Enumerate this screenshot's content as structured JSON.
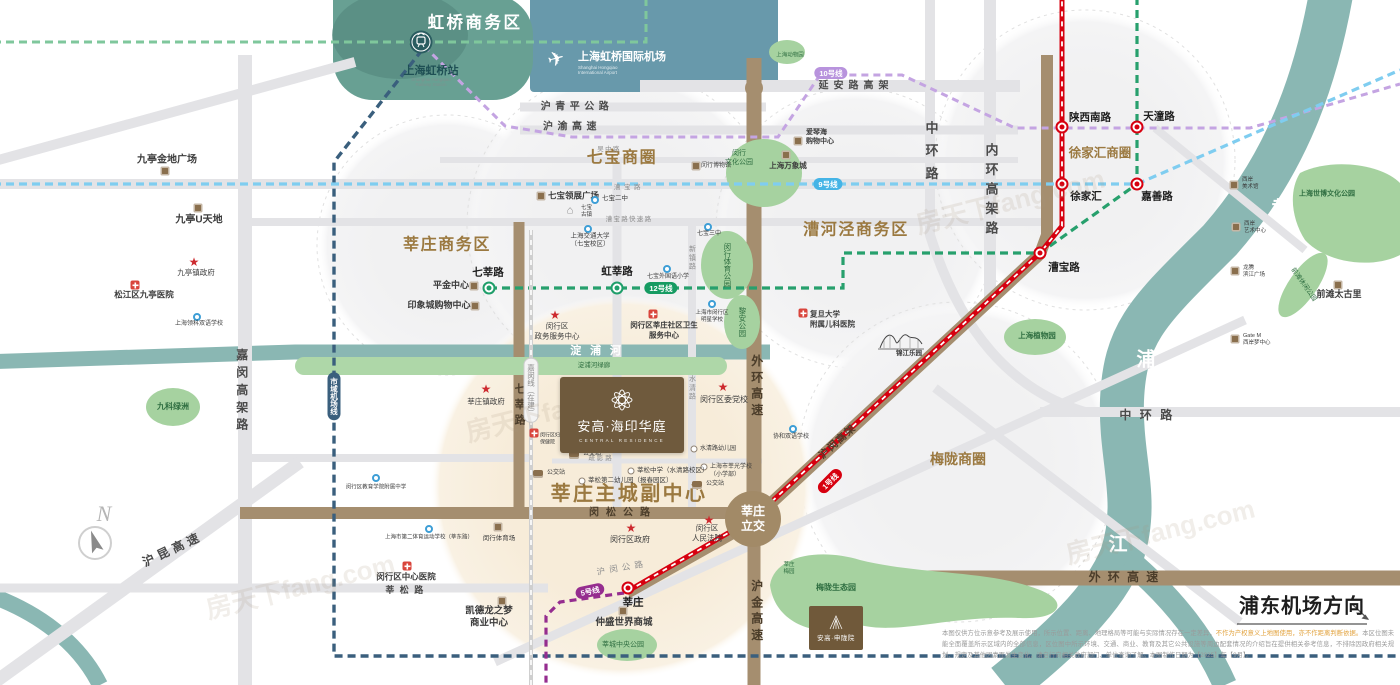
{
  "colors": {
    "brown": "#9b7940",
    "dbrown": "#4b3d2a",
    "ink": "#4a4a4a",
    "grey": "#8f8f8f",
    "white": "#ffffff",
    "green": "#2f6e41",
    "teal": "#1e4f54",
    "accent_red": "#d7000f",
    "metro_green": "#1f9e6a",
    "road_brown": "#a58e6f",
    "river_teal": "#8ab7b3",
    "park_green": "#a6d2a0"
  },
  "hongqiao": {
    "district": "虹桥商务区",
    "station_cn": "上海虹桥站",
    "station_en": "Shanghai Hongqiao\nRailway Station",
    "airport_cn": "上海虹桥国际机场",
    "airport_en": "Shanghai Hongqiao\nInternational Airport"
  },
  "property": {
    "cn": "安高·海印华庭",
    "en": "CENTRAL RESIDENCE"
  },
  "property2": {
    "cn": "安高·申陇院"
  },
  "interchange": {
    "t": "莘庄\n立交"
  },
  "direction": {
    "t": "浦东机场方向"
  },
  "compass": {
    "t": "N"
  },
  "watermark": "房天下fang.com",
  "disclaimer": {
    "p1": "本图仅供方位示意参考及展示使用，所示位置、距离、地理格局等可能与实际情况存在一定差异，",
    "hl": "不作为产权意义上地图使用，亦不作距离判断依据。",
    "p2": "本区位图未能全面覆盖所示区域内的全部信息，区位图中所示环境、交通、商业、教育及其它公共设施等周边配套情况的介绍旨在提供相关参考信息，不排除因政府相关规划、规定及其他因素而发生变化，请自行向相关政府部门、单位查询了解。本图制作日期为【2025】年【9月】。"
  },
  "labels": [
    {
      "n": "district-qibao",
      "t": "七宝商圈",
      "x": 622,
      "y": 159,
      "s": 16,
      "c": "brown",
      "b": 1,
      "ls": 0.1
    },
    {
      "n": "district-xinzhuang-biz",
      "t": "莘庄商务区",
      "x": 447,
      "y": 246,
      "s": 16,
      "c": "brown",
      "b": 1,
      "ls": 0.1
    },
    {
      "n": "district-caohejing",
      "t": "漕河泾商务区",
      "x": 856,
      "y": 231,
      "s": 16,
      "c": "brown",
      "b": 1,
      "ls": 0.1
    },
    {
      "n": "district-xujiahui",
      "t": "徐家汇商圈",
      "x": 1100,
      "y": 153,
      "s": 12.5,
      "c": "brown",
      "b": 1
    },
    {
      "n": "district-meilong",
      "t": "梅陇商圈",
      "x": 958,
      "y": 459,
      "s": 14,
      "c": "brown",
      "b": 1
    },
    {
      "n": "label-subcenter",
      "t": "莘庄主城副中心",
      "x": 629,
      "y": 494,
      "s": 20,
      "c": "brown",
      "b": 1,
      "ls": 0.12
    },
    {
      "n": "road-huqingping",
      "t": "沪青平公路",
      "x": 577,
      "y": 107,
      "s": 10,
      "c": "ink",
      "b": 1,
      "ls": 0.45
    },
    {
      "n": "road-huyu",
      "t": "沪渝高速",
      "x": 572,
      "y": 127,
      "s": 10,
      "c": "ink",
      "b": 1,
      "ls": 0.45
    },
    {
      "n": "road-wuzhong",
      "t": "吴中路",
      "x": 609,
      "y": 150,
      "s": 6.5,
      "c": "grey",
      "ls": 0.2
    },
    {
      "n": "road-caobao",
      "t": "漕宝路",
      "x": 629,
      "y": 188,
      "s": 6.5,
      "c": "grey",
      "ls": 0.55
    },
    {
      "n": "road-caobao-exp",
      "t": "漕宝路快速路",
      "x": 629,
      "y": 220,
      "s": 6.5,
      "c": "grey",
      "ls": 0.2
    },
    {
      "n": "road-yanan-elevated",
      "t": "延安路高架",
      "x": 856,
      "y": 86,
      "s": 10,
      "c": "ink",
      "b": 1,
      "ls": 0.5
    },
    {
      "n": "road-zhonghuan-v",
      "t": "中环路",
      "x": 930,
      "y": 155,
      "s": 13,
      "c": "ink",
      "b": 1,
      "v": 1,
      "ls": 0.75
    },
    {
      "n": "road-neihuan-v",
      "t": "内环高架路",
      "x": 990,
      "y": 192,
      "s": 13,
      "c": "ink",
      "b": 1,
      "v": 1,
      "ls": 0.5
    },
    {
      "n": "road-zhonghuan-h",
      "t": "中环路",
      "x": 1150,
      "y": 416,
      "s": 12,
      "c": "ink",
      "b": 1,
      "ls": 0.7
    },
    {
      "n": "road-jiamin-elevated",
      "t": "嘉闵高架路",
      "x": 241,
      "y": 392,
      "s": 12,
      "c": "ink",
      "b": 1,
      "v": 1,
      "ls": 0.45
    },
    {
      "n": "road-hukun",
      "t": "沪昆高速",
      "x": 173,
      "y": 550,
      "s": 12,
      "c": "ink",
      "b": 1,
      "r": -25,
      "ls": 0.35
    },
    {
      "n": "road-qixin",
      "t": "七莘路",
      "x": 519,
      "y": 406,
      "s": 11,
      "c": "dbrown",
      "b": 1,
      "v": 1,
      "ls": 0.4
    },
    {
      "n": "road-waihuan-v",
      "t": "外环高速",
      "x": 756,
      "y": 387,
      "s": 12,
      "c": "dbrown",
      "b": 1,
      "v": 1,
      "ls": 0.35
    },
    {
      "n": "road-hujin-v",
      "t": "沪金高速",
      "x": 756,
      "y": 612,
      "s": 12,
      "c": "dbrown",
      "b": 1,
      "v": 1,
      "ls": 0.35
    },
    {
      "n": "road-waihuan-h",
      "t": "外环高速",
      "x": 1127,
      "y": 578,
      "s": 12,
      "c": "dbrown",
      "b": 1,
      "ls": 0.6
    },
    {
      "n": "road-minsong",
      "t": "闵松公路",
      "x": 623,
      "y": 513,
      "s": 10,
      "c": "dbrown",
      "b": 1,
      "ls": 0.7
    },
    {
      "n": "road-xinsong",
      "t": "莘松路",
      "x": 407,
      "y": 591,
      "s": 9,
      "c": "ink",
      "b": 1,
      "ls": 0.6
    },
    {
      "n": "road-humin-hwy",
      "t": "沪闵公路",
      "x": 622,
      "y": 568,
      "s": 8.5,
      "c": "grey",
      "r": -10,
      "ls": 0.5
    },
    {
      "n": "road-humin-elevated",
      "t": "沪闵高架",
      "x": 838,
      "y": 442,
      "s": 10,
      "c": "dbrown",
      "b": 1,
      "r": -42,
      "ls": 0.15
    },
    {
      "n": "road-shuying",
      "t": "疏影路",
      "x": 601,
      "y": 459,
      "s": 6.5,
      "c": "grey",
      "ls": 0.3
    },
    {
      "n": "road-shuiqing",
      "t": "水清路",
      "x": 692,
      "y": 388,
      "s": 7,
      "c": "grey",
      "v": 1,
      "ls": 0.25
    },
    {
      "n": "road-xinzhen",
      "t": "新镇路",
      "x": 692,
      "y": 258,
      "s": 7,
      "c": "grey",
      "v": 1,
      "ls": 0.25
    },
    {
      "n": "river-dianpu",
      "t": "淀浦河",
      "x": 600,
      "y": 351,
      "s": 11,
      "c": "white",
      "b": 1,
      "ls": 0.8
    },
    {
      "n": "river-huangpu-huang",
      "t": "黄",
      "x": 1281,
      "y": 210,
      "s": 19,
      "c": "white",
      "b": 1
    },
    {
      "n": "river-huangpu-pu",
      "t": "浦",
      "x": 1146,
      "y": 361,
      "s": 19,
      "c": "white",
      "b": 1
    },
    {
      "n": "river-huangpu-jiang",
      "t": "江",
      "x": 1118,
      "y": 546,
      "s": 19,
      "c": "white",
      "b": 1
    },
    {
      "n": "park-dianpu-greenway",
      "t": "淀浦河绿廊",
      "x": 594,
      "y": 366,
      "s": 6.5,
      "c": "green"
    },
    {
      "n": "park-minhang-culture",
      "t": "闵行\n文化公园",
      "x": 739,
      "y": 158,
      "s": 7,
      "c": "green"
    },
    {
      "n": "park-minhang-sports",
      "t": "闵行体育公园",
      "x": 727,
      "y": 265,
      "s": 7.5,
      "c": "green",
      "v": 1
    },
    {
      "n": "park-lian",
      "t": "黎安公园",
      "x": 742,
      "y": 322,
      "s": 7.5,
      "c": "green",
      "v": 1
    },
    {
      "n": "park-botanical",
      "t": "上海植物园",
      "x": 1037,
      "y": 336,
      "s": 7.5,
      "c": "green",
      "b": 1
    },
    {
      "n": "park-expo-culture",
      "t": "上海世博文化公园",
      "x": 1327,
      "y": 194,
      "s": 7,
      "c": "green",
      "b": 1
    },
    {
      "n": "park-qiantan-leisure",
      "t": "前滩休闲公园",
      "x": 1303,
      "y": 285,
      "s": 6.5,
      "c": "green",
      "r": 55
    },
    {
      "n": "park-xincheng-central",
      "t": "莘城中央公园",
      "x": 623,
      "y": 645,
      "s": 7,
      "c": "green"
    },
    {
      "n": "park-meilong-eco",
      "t": "梅陇生态园",
      "x": 836,
      "y": 588,
      "s": 8,
      "c": "green",
      "b": 1
    },
    {
      "n": "park-xinzhuang-plum",
      "t": "莘庄\n梅园",
      "x": 789,
      "y": 569,
      "s": 5.5,
      "c": "green"
    },
    {
      "n": "park-jiuke-oasis",
      "t": "九科绿洲",
      "x": 173,
      "y": 407,
      "s": 8,
      "c": "green",
      "b": 1
    },
    {
      "n": "park-zoo",
      "t": "上海动物园",
      "x": 790,
      "y": 56,
      "s": 5.5,
      "c": "green"
    }
  ],
  "badges": [
    {
      "n": "badge-line10",
      "t": "10号线",
      "x": 831,
      "y": 73,
      "k": "l10"
    },
    {
      "n": "badge-line9",
      "t": "9号线",
      "x": 828,
      "y": 184,
      "k": "l9"
    },
    {
      "n": "badge-line12",
      "t": "12号线",
      "x": 661,
      "y": 288,
      "k": "l12"
    },
    {
      "n": "badge-line5",
      "t": "5号线",
      "x": 590,
      "y": 591,
      "k": "l5",
      "r": -12
    },
    {
      "n": "badge-line1",
      "t": "1号线",
      "x": 830,
      "y": 481,
      "k": "l1",
      "r": -45
    },
    {
      "n": "badge-airport-link-line",
      "t": "市域机场线",
      "x": 334,
      "y": 396,
      "k": "airlink",
      "v": 1
    },
    {
      "n": "badge-jiamin-line",
      "t": "嘉闵线（在建）",
      "x": 531,
      "y": 390,
      "k": "jiamin",
      "v": 1
    }
  ],
  "stations": [
    {
      "n": "station-shanxinanlu",
      "t": "陕西南路",
      "x": 1062,
      "y": 127,
      "lx": 1090,
      "ly": 117
    },
    {
      "n": "station-tiantonglu",
      "t": "天潼路",
      "x": 1137,
      "y": 127,
      "lx": 1159,
      "ly": 116
    },
    {
      "n": "station-xujiahui",
      "t": "徐家汇",
      "x": 1062,
      "y": 184,
      "lx": 1086,
      "ly": 196
    },
    {
      "n": "station-jiashanlu",
      "t": "嘉善路",
      "x": 1137,
      "y": 184,
      "lx": 1157,
      "ly": 196
    },
    {
      "n": "station-caobaolu",
      "t": "漕宝路",
      "x": 1040,
      "y": 253,
      "lx": 1064,
      "ly": 267
    },
    {
      "n": "station-xinzhuang",
      "t": "莘庄",
      "x": 628,
      "y": 588,
      "lx": 633,
      "ly": 602
    },
    {
      "n": "station-qixinlu",
      "t": "七莘路",
      "x": 489,
      "y": 288,
      "g": 1,
      "lx": 488,
      "ly": 272
    },
    {
      "n": "station-hongxinlu",
      "t": "虹莘路",
      "x": 617,
      "y": 288,
      "g": 1,
      "lx": 617,
      "ly": 271
    }
  ],
  "pois": [
    {
      "n": "poi-jiuting-gemdale",
      "icon": "shop",
      "ix": 165,
      "iy": 171,
      "t": "九亭金地广场",
      "x": 167,
      "y": 160,
      "s": 10,
      "b": 1
    },
    {
      "n": "poi-jiuting-u",
      "icon": "shop",
      "ix": 198,
      "iy": 208,
      "t": "九亭U天地",
      "x": 199,
      "y": 220,
      "s": 10,
      "b": 1
    },
    {
      "n": "poi-jiuting-gov",
      "icon": "star",
      "ix": 194,
      "iy": 262,
      "t": "九亭镇政府",
      "x": 196,
      "y": 273,
      "s": 7.5
    },
    {
      "n": "poi-jiuting-hospital",
      "icon": "cross",
      "ix": 135,
      "iy": 285,
      "t": "松江区九亭医院",
      "x": 144,
      "y": 295,
      "s": 8.5,
      "b": 1
    },
    {
      "n": "poi-lingke-school",
      "icon": "school",
      "ix": 197,
      "iy": 317,
      "t": "上海领科双语学校",
      "x": 199,
      "y": 325,
      "s": 6
    },
    {
      "n": "poi-pingjin-center",
      "icon": "shop",
      "ix": 474,
      "iy": 286,
      "t": "平金中心",
      "x": 451,
      "y": 286,
      "s": 9,
      "b": 1
    },
    {
      "n": "poi-yinxiangcheng",
      "icon": "shop",
      "ix": 475,
      "iy": 306,
      "t": "印象城购物中心",
      "x": 439,
      "y": 306,
      "s": 9,
      "b": 1
    },
    {
      "n": "poi-qibao-lingzhan",
      "icon": "shop",
      "ix": 541,
      "iy": 196,
      "t": "七宝领展广场",
      "x": 548,
      "y": 196,
      "s": 8.5,
      "b": 1,
      "a": "l"
    },
    {
      "n": "poi-qibao-oldtown",
      "icon": "pav",
      "ix": 570,
      "iy": 211,
      "t": "七宝\n古镇",
      "x": 581,
      "y": 212,
      "s": 5.5,
      "a": "l"
    },
    {
      "n": "poi-qibao-no2",
      "icon": "school",
      "ix": 595,
      "iy": 200,
      "t": "七宝二中",
      "x": 602,
      "y": 199,
      "s": 6.5,
      "a": "l"
    },
    {
      "n": "poi-jiaotong-univ",
      "icon": "school",
      "ix": 588,
      "iy": 229,
      "t": "上海交通大学\n（七宝校区）",
      "x": 590,
      "y": 241,
      "s": 6.5
    },
    {
      "n": "poi-qibao-no3",
      "icon": "school",
      "ix": 708,
      "iy": 227,
      "t": "七宝三中",
      "x": 709,
      "y": 235,
      "s": 6
    },
    {
      "n": "poi-qibao-foreign",
      "icon": "school",
      "ix": 667,
      "iy": 269,
      "t": "七宝外国语小学",
      "x": 668,
      "y": 278,
      "s": 6
    },
    {
      "n": "poi-minhang-museum",
      "icon": "shop",
      "ix": 696,
      "iy": 166,
      "t": "闵行博物馆",
      "x": 701,
      "y": 167,
      "s": 6,
      "a": "l"
    },
    {
      "n": "poi-aegean-mall",
      "icon": "shop",
      "ix": 798,
      "iy": 141,
      "t": "爱琴海\n购物中心",
      "x": 806,
      "y": 137,
      "s": 7,
      "b": 1,
      "a": "l"
    },
    {
      "n": "poi-mixc",
      "icon": "shop",
      "ix": 786,
      "iy": 155,
      "t": "上海万象城",
      "x": 788,
      "y": 166,
      "s": 7.5,
      "b": 1
    },
    {
      "n": "poi-gov-service-center",
      "icon": "star",
      "ix": 555,
      "iy": 315,
      "t": "闵行区\n政务服务中心",
      "x": 557,
      "y": 331,
      "s": 7.5
    },
    {
      "n": "poi-community-health",
      "icon": "cross",
      "ix": 653,
      "iy": 314,
      "t": "闵行区莘庄社区卫生\n服务中心",
      "x": 664,
      "y": 330,
      "s": 7.5,
      "b": 1
    },
    {
      "n": "poi-mingxing-school",
      "icon": "school",
      "ix": 712,
      "iy": 304,
      "t": "上海市闵行区\n明星学校",
      "x": 712,
      "y": 317,
      "s": 5.5
    },
    {
      "n": "poi-xinzhuang-gov",
      "icon": "star",
      "ix": 486,
      "iy": 389,
      "t": "莘庄镇政府",
      "x": 486,
      "y": 402,
      "s": 7.5
    },
    {
      "n": "poi-party-school",
      "icon": "star",
      "ix": 723,
      "iy": 387,
      "t": "闵行区委党校",
      "x": 724,
      "y": 400,
      "s": 8
    },
    {
      "n": "poi-fuyou",
      "icon": "cross",
      "ix": 534,
      "iy": 433,
      "t": "闵行区妇幼\n保健院",
      "x": 540,
      "y": 439,
      "s": 5,
      "a": "l"
    },
    {
      "n": "poi-shuiqing-kindergarten",
      "icon": "pin",
      "ix": 694,
      "iy": 449,
      "t": "水清路幼儿园",
      "x": 700,
      "y": 450,
      "s": 6,
      "a": "l"
    },
    {
      "n": "poi-xinguang-school",
      "icon": "pin",
      "ix": 704,
      "iy": 467,
      "t": "上海市莘光学校\n（小学部）",
      "x": 710,
      "y": 472,
      "s": 6,
      "a": "l"
    },
    {
      "n": "poi-xinsong-middle",
      "icon": "pin",
      "ix": 631,
      "iy": 471,
      "t": "莘松中学（水清路校区）",
      "x": 637,
      "y": 471,
      "s": 6.5,
      "a": "l"
    },
    {
      "n": "poi-xinsong-kindergarten",
      "icon": "pin",
      "ix": 582,
      "iy": 481,
      "t": "莘松第二幼儿园（报春园区）",
      "x": 588,
      "y": 481,
      "s": 6.5,
      "a": "l"
    },
    {
      "n": "poi-bus-stop-1",
      "icon": "bus",
      "ix": 574,
      "iy": 455,
      "t": "公交站",
      "x": 583,
      "y": 455,
      "s": 6,
      "a": "l"
    },
    {
      "n": "poi-bus-stop-2",
      "icon": "bus",
      "ix": 538,
      "iy": 474,
      "t": "公交站",
      "x": 547,
      "y": 474,
      "s": 6,
      "a": "l"
    },
    {
      "n": "poi-bus-stop-3",
      "icon": "bus",
      "ix": 697,
      "iy": 485,
      "t": "公交站",
      "x": 706,
      "y": 485,
      "s": 6,
      "a": "l"
    },
    {
      "n": "poi-edu-college-school",
      "icon": "school",
      "ix": 376,
      "iy": 478,
      "t": "闵行区教育学院附属中学",
      "x": 376,
      "y": 488,
      "s": 5.5
    },
    {
      "n": "poi-sports-school",
      "icon": "school",
      "ix": 429,
      "iy": 529,
      "t": "上海市第二体育运动学校（莘东路）",
      "x": 429,
      "y": 538,
      "s": 5.5
    },
    {
      "n": "poi-minhang-stadium",
      "icon": "shop",
      "ix": 498,
      "iy": 527,
      "t": "闵行体育场",
      "x": 499,
      "y": 539,
      "s": 6.5
    },
    {
      "n": "poi-minhang-hospital",
      "icon": "cross",
      "ix": 407,
      "iy": 566,
      "t": "闵行区中心医院",
      "x": 406,
      "y": 577,
      "s": 8.5,
      "b": 1
    },
    {
      "n": "poi-capitaland",
      "icon": "shop",
      "ix": 502,
      "iy": 601,
      "t": "凯德龙之梦\n商业中心",
      "x": 489,
      "y": 618,
      "s": 9.5,
      "b": 1
    },
    {
      "n": "poi-zhongsheng-mall",
      "icon": "shop",
      "ix": 623,
      "iy": 611,
      "t": "仲盛世界商城",
      "x": 624,
      "y": 623,
      "s": 9.5,
      "b": 1
    },
    {
      "n": "poi-minhang-gov",
      "icon": "star",
      "ix": 631,
      "iy": 528,
      "t": "闵行区政府",
      "x": 630,
      "y": 540,
      "s": 8
    },
    {
      "n": "poi-minhang-court",
      "icon": "star",
      "ix": 709,
      "iy": 520,
      "t": "闵行区\n人民法院",
      "x": 707,
      "y": 533,
      "s": 7.5
    },
    {
      "n": "poi-xiehe-school",
      "icon": "school",
      "ix": 793,
      "iy": 429,
      "t": "协和双语学校",
      "x": 791,
      "y": 438,
      "s": 6
    },
    {
      "n": "poi-fudan-children-hospital",
      "icon": "cross",
      "ix": 803,
      "iy": 313,
      "t": "复旦大学\n附属儿科医院",
      "x": 810,
      "y": 319,
      "s": 7.5,
      "b": 1,
      "a": "l"
    },
    {
      "n": "poi-jinjiang-park",
      "icon": "none",
      "ix": 0,
      "iy": 0,
      "t": "锦江乐园",
      "x": 909,
      "y": 354,
      "s": 6.5,
      "b": 1
    },
    {
      "n": "poi-qiantan-taikooli",
      "icon": "shop",
      "ix": 1338,
      "iy": 285,
      "t": "前滩太古里",
      "x": 1339,
      "y": 295,
      "s": 9,
      "b": 1
    },
    {
      "n": "poi-westbund-museum",
      "icon": "shop",
      "ix": 1234,
      "iy": 185,
      "t": "西岸\n美术馆",
      "x": 1242,
      "y": 184,
      "s": 5.5,
      "a": "l"
    },
    {
      "n": "poi-westbund-art-center",
      "icon": "shop",
      "ix": 1236,
      "iy": 227,
      "t": "西岸\n艺术中心",
      "x": 1244,
      "y": 228,
      "s": 5.5,
      "a": "l"
    },
    {
      "n": "poi-binjiang-plaza",
      "icon": "shop",
      "ix": 1235,
      "iy": 271,
      "t": "龙腾\n滨江广场",
      "x": 1243,
      "y": 272,
      "s": 5.5,
      "a": "l"
    },
    {
      "n": "poi-gate-m",
      "icon": "shop",
      "ix": 1235,
      "iy": 339,
      "t": "Gate M\n西岸梦中心",
      "x": 1243,
      "y": 340,
      "s": 5.5,
      "a": "l"
    }
  ],
  "watermarks": [
    {
      "x": 560,
      "y": 408,
      "r": -14
    },
    {
      "x": 1010,
      "y": 200,
      "r": -14
    },
    {
      "x": 1160,
      "y": 530,
      "r": -14
    },
    {
      "x": 300,
      "y": 585,
      "r": -14
    }
  ]
}
